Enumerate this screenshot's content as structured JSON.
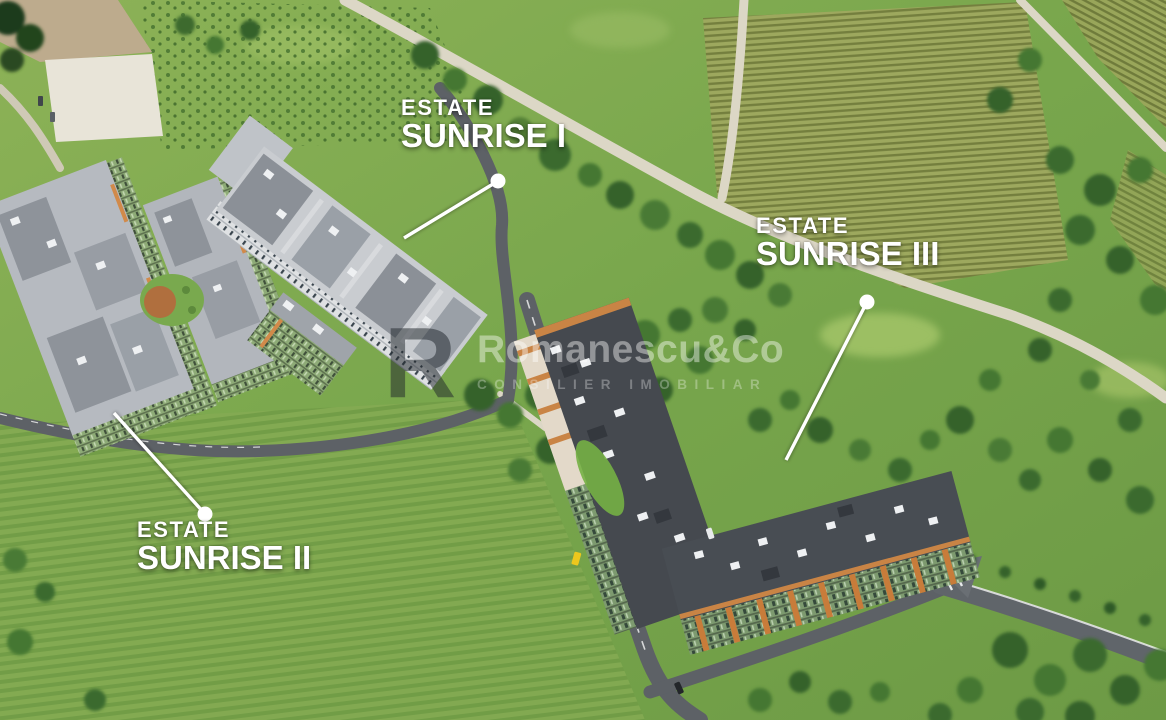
{
  "labels": [
    {
      "kicker": "ESTATE",
      "title": "SUNRISE I"
    },
    {
      "kicker": "ESTATE",
      "title": "SUNRISE II"
    },
    {
      "kicker": "ESTATE",
      "title": "SUNRISE III"
    }
  ],
  "watermark": {
    "logo_letter": "R",
    "brand": "Romanescu&Co",
    "tagline": "CONSILIER IMOBILIAR"
  },
  "colors": {
    "label_text": "#ffffff",
    "leader_line": "#ffffff",
    "grass": "#7ba94e",
    "dark_roof": "#45494f",
    "light_roof": "#bcc0c5",
    "dirt_road": "#dcd7c6",
    "asphalt_road": "#5d6166",
    "facade_orange": "#c98445",
    "facade_green": "#8fae7e",
    "vineyard": "#9aa75c",
    "sand_lot": "#e8e4d8"
  }
}
